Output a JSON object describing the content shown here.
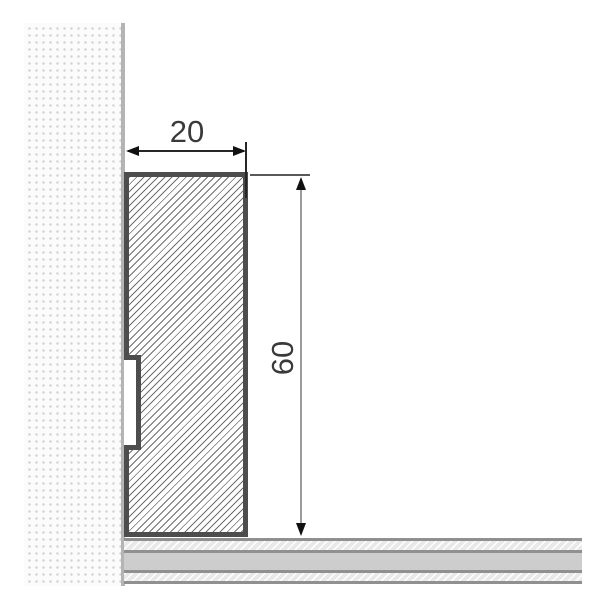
{
  "drawing": {
    "width_label": "20",
    "height_label": "60",
    "colors": {
      "profile_outline": "#4d4d4d",
      "profile_hatch_line": "#6e6e6e",
      "wall_dot": "#d2d2d2",
      "wall_edge": "#b4b4b4",
      "floor_divider": "#909090",
      "floor_solid_band": "#cdcdcd",
      "floor_hatch_band": "#e9e9e9",
      "dimension_text": "#3a3a3a",
      "dimension_line_dark": "#262626",
      "dimension_line_gray": "#9c9c9c",
      "arrowhead": "#111111"
    }
  }
}
